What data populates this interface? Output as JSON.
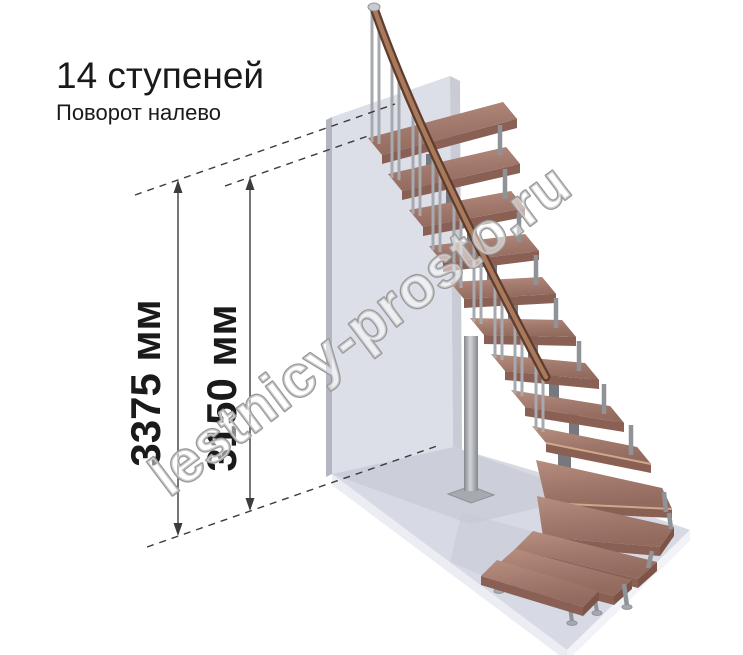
{
  "header": {
    "title": "14 ступеней",
    "subtitle": "Поворот налево"
  },
  "dimensions": {
    "total_height": "3375 мм",
    "to_top_step": "3150 мм"
  },
  "watermark": {
    "text": "lestnicy-prosto.ru"
  },
  "colors": {
    "text": "#1a1a1a",
    "dim": "#3c3c3c",
    "watermark_stroke": "#999999",
    "wall_front": "#dcdfe8",
    "wall_side_left": "#b3b6c0",
    "wall_top": "#edeff5",
    "wall_right": "#c9ccd5",
    "floor_top": "#d7dae4",
    "floor_shadow": "#c7cad6",
    "floor_front": "#ebedf3",
    "floor_front2": "#f2f3f7",
    "wood_top": "#a1786c",
    "wood_top_light": "#b58e7e",
    "wood_front": "#8a6054",
    "wood_end": "#7c5448",
    "wood_edge": "#cfa88c",
    "steel": "#a6a9ae",
    "steel_dark": "#8f9297",
    "spine": "#75787e",
    "rail_dark": "#5f3c2c",
    "rail_mid": "#a9795c"
  }
}
